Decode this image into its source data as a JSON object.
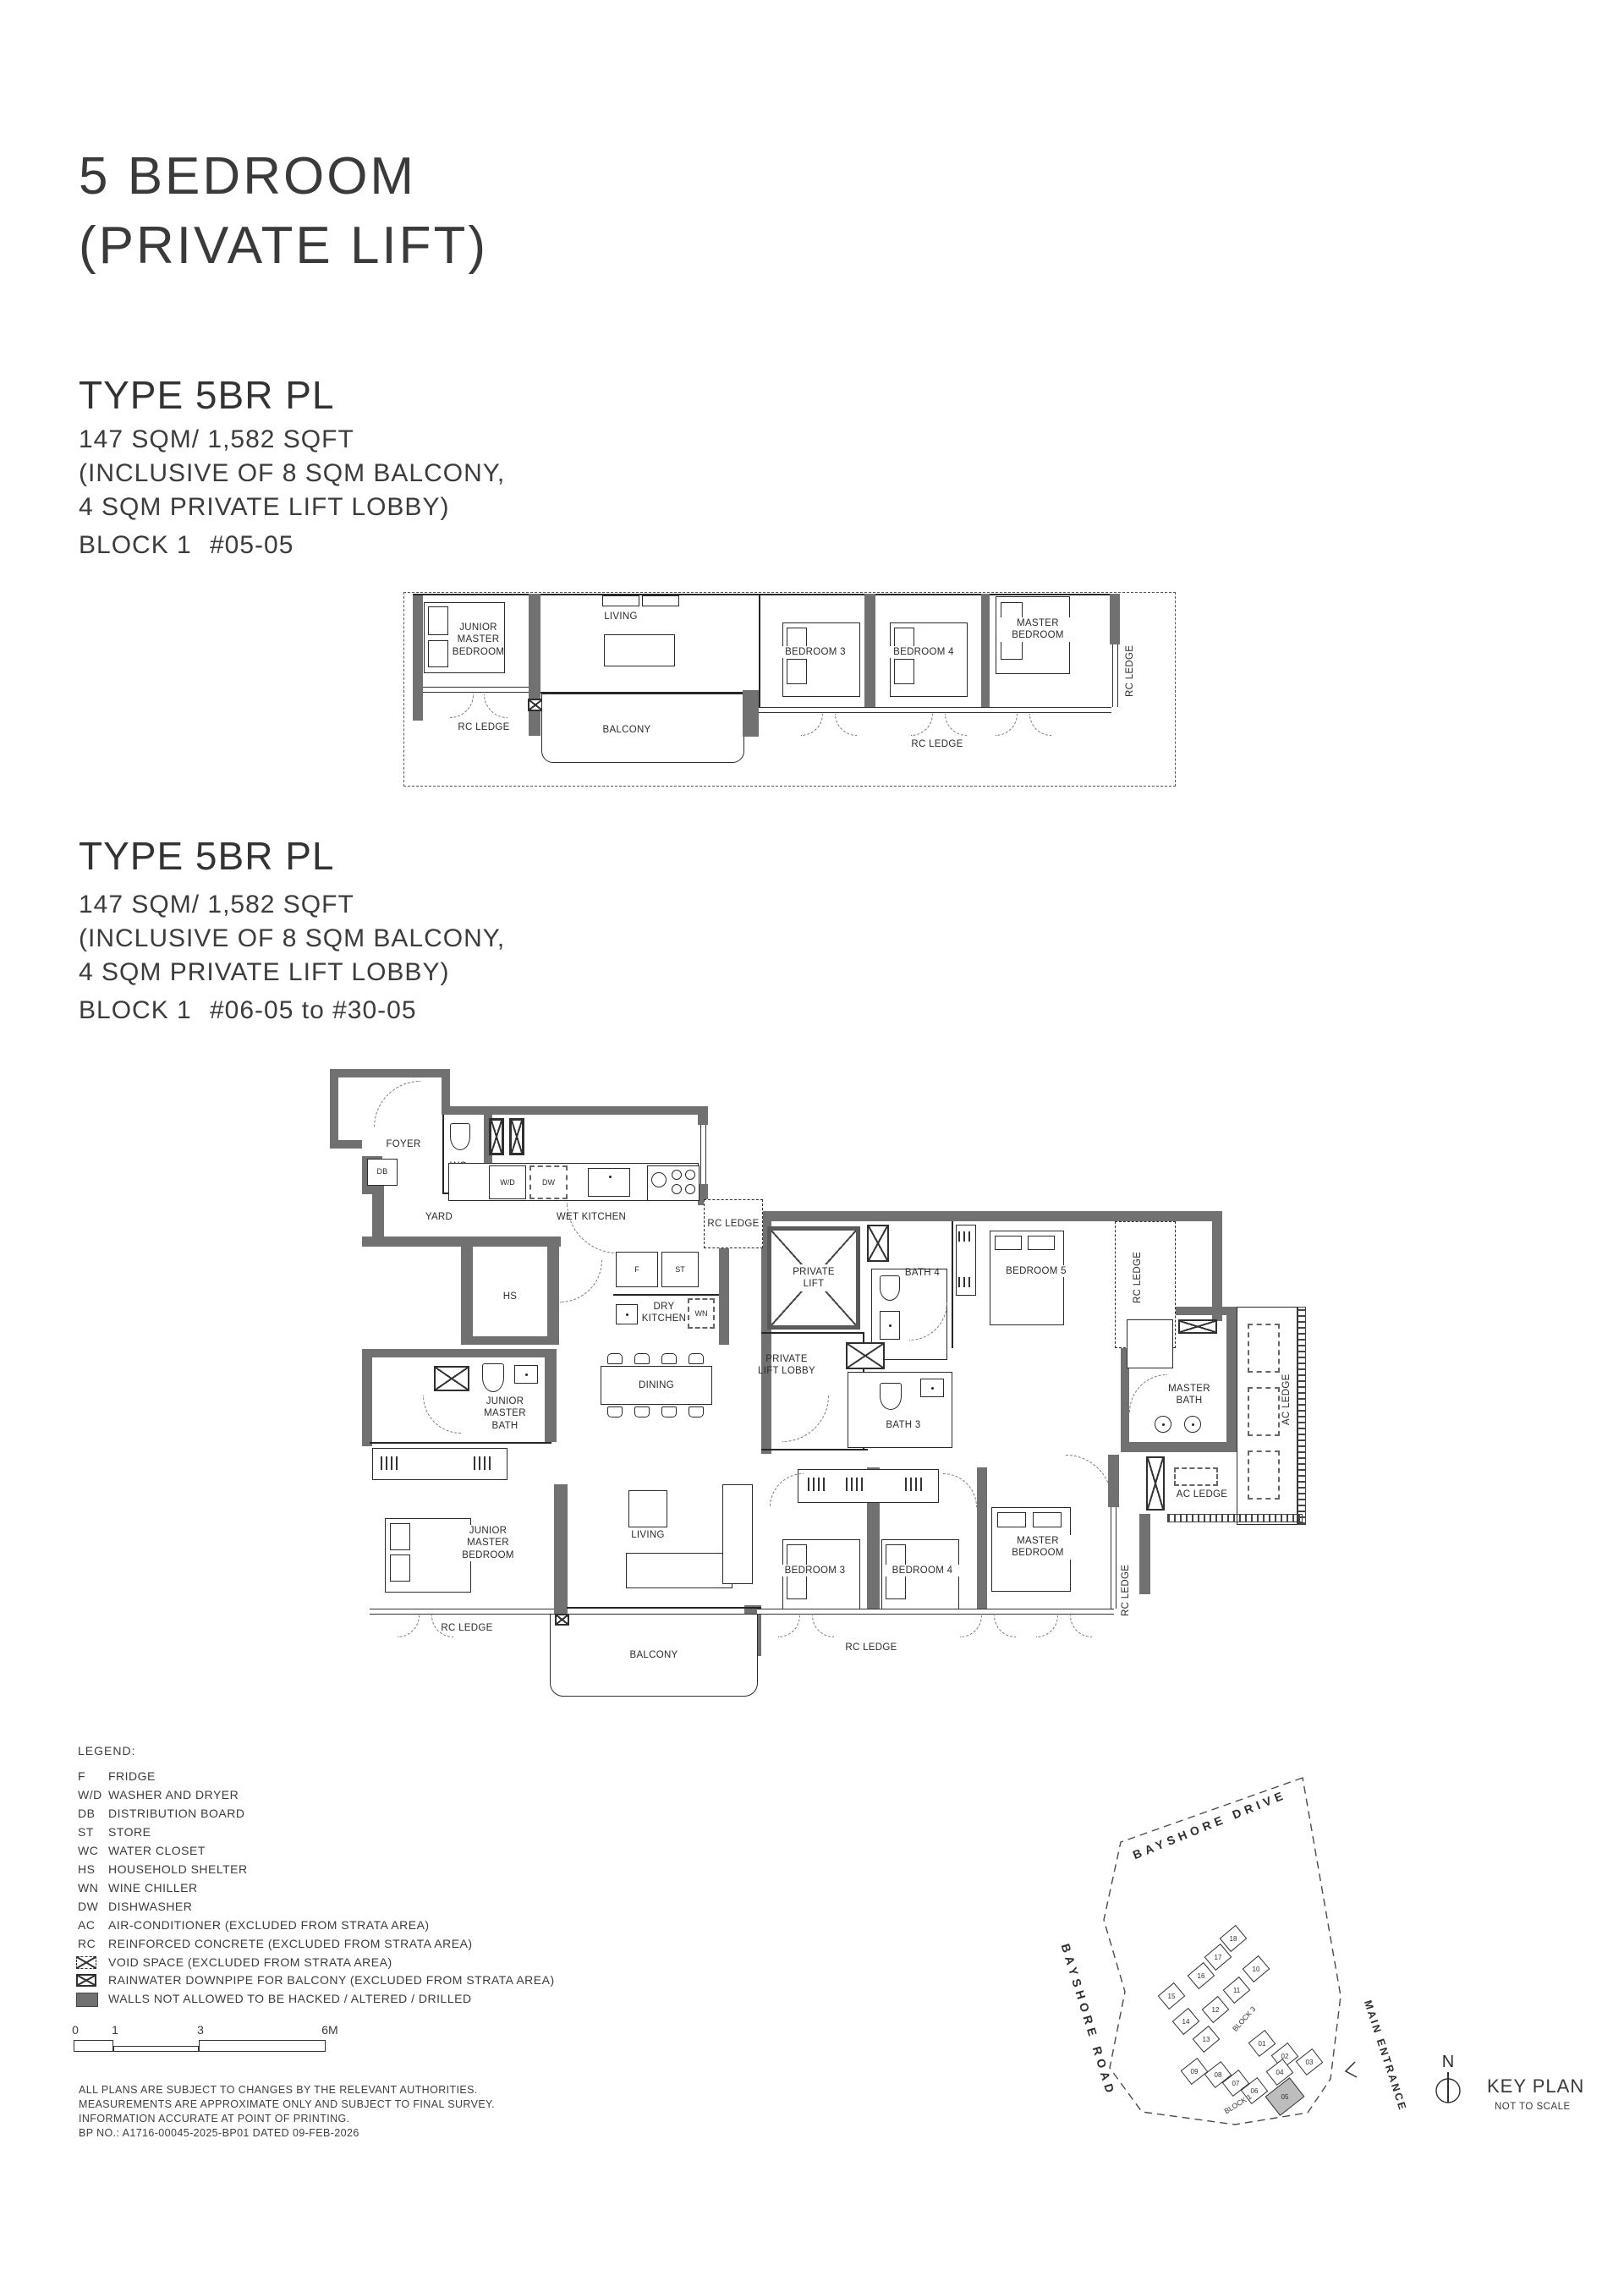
{
  "page": {
    "title_line1": "5 BEDROOM",
    "title_line2": "(PRIVATE LIFT)"
  },
  "types": {
    "t1": {
      "heading": "TYPE 5BR PL",
      "area": "147 SQM/ 1,582 SQFT",
      "incl1": "(INCLUSIVE OF 8 SQM BALCONY,",
      "incl2": "4 SQM PRIVATE LIFT LOBBY)",
      "block": "BLOCK 1",
      "unit": "#05-05"
    },
    "t2": {
      "heading": "TYPE 5BR PL",
      "area": "147 SQM/ 1,582 SQFT",
      "incl1": "(INCLUSIVE OF 8 SQM BALCONY,",
      "incl2": "4 SQM PRIVATE LIFT LOBBY)",
      "block": "BLOCK 1",
      "unit": "#06-05 to #30-05"
    }
  },
  "plan1": {
    "labels": {
      "junior_master_bedroom": "JUNIOR\nMASTER\nBEDROOM",
      "living": "LIVING",
      "bedroom3": "BEDROOM 3",
      "bedroom4": "BEDROOM 4",
      "master_bedroom": "MASTER\nBEDROOM",
      "rc_ledge_left": "RC LEDGE",
      "balcony": "BALCONY",
      "rc_ledge_bottom": "RC LEDGE",
      "rc_ledge_right": "RC LEDGE"
    }
  },
  "plan2": {
    "labels": {
      "foyer": "FOYER",
      "db": "DB",
      "wc": "WC",
      "yard": "YARD",
      "wet_kitchen": "WET KITCHEN",
      "wd": "W/D",
      "dw": "DW",
      "rc_ledge_top": "RC LEDGE",
      "hs": "HS",
      "f": "F",
      "st": "ST",
      "dry_kitchen": "DRY\nKITCHEN",
      "wn": "WN",
      "private_lift": "PRIVATE\nLIFT",
      "bath4": "BATH 4",
      "bedroom5": "BEDROOM 5",
      "rc_ledge_right": "RC LEDGE",
      "private_lift_lobby": "PRIVATE\nLIFT LOBBY",
      "bath3": "BATH 3",
      "master_bath": "MASTER\nBATH",
      "ac_ledge_right": "AC LEDGE",
      "ac_ledge_bottom": "AC LEDGE",
      "junior_master_bath": "JUNIOR\nMASTER\nBATH",
      "dining": "DINING",
      "junior_master_bedroom": "JUNIOR\nMASTER\nBEDROOM",
      "living": "LIVING",
      "bedroom3": "BEDROOM 3",
      "bedroom4": "BEDROOM 4",
      "master_bedroom": "MASTER\nBEDROOM",
      "rc_ledge_bottom_left": "RC LEDGE",
      "balcony": "BALCONY",
      "rc_ledge_bottom_mid": "RC LEDGE",
      "rc_ledge_bottom_right": "RC LEDGE"
    }
  },
  "legend": {
    "title": "LEGEND:",
    "items": [
      {
        "abbr": "F",
        "desc": "FRIDGE"
      },
      {
        "abbr": "W/D",
        "desc": "WASHER AND DRYER"
      },
      {
        "abbr": "DB",
        "desc": "DISTRIBUTION BOARD"
      },
      {
        "abbr": "ST",
        "desc": "STORE"
      },
      {
        "abbr": "WC",
        "desc": "WATER CLOSET"
      },
      {
        "abbr": "HS",
        "desc": "HOUSEHOLD SHELTER"
      },
      {
        "abbr": "WN",
        "desc": "WINE CHILLER"
      },
      {
        "abbr": "DW",
        "desc": "DISHWASHER"
      },
      {
        "abbr": "AC",
        "desc": "AIR-CONDITIONER (EXCLUDED FROM STRATA AREA)"
      },
      {
        "abbr": "RC",
        "desc": "REINFORCED CONCRETE (EXCLUDED FROM STRATA AREA)"
      }
    ],
    "icon_items": [
      {
        "icon": "void-space-icon",
        "desc": "VOID SPACE (EXCLUDED FROM STRATA AREA)"
      },
      {
        "icon": "rainwater-downpipe-icon",
        "desc": "RAINWATER DOWNPIPE FOR BALCONY (EXCLUDED FROM STRATA AREA)"
      },
      {
        "icon": "wall-swatch-icon",
        "desc": "WALLS NOT ALLOWED TO BE HACKED / ALTERED / DRILLED"
      }
    ]
  },
  "scalebar": {
    "t0": "0",
    "t1": "1",
    "t3": "3",
    "t6": "6M"
  },
  "disclaimer": {
    "lines": [
      "ALL PLANS ARE SUBJECT TO CHANGES BY THE RELEVANT AUTHORITIES.",
      "MEASUREMENTS ARE APPROXIMATE ONLY AND SUBJECT TO FINAL SURVEY.",
      "INFORMATION ACCURATE AT POINT OF PRINTING.",
      "BP NO.: A1716-00045-2025-BP01  DATED 09-FEB-2026"
    ]
  },
  "keyplan": {
    "roads": {
      "top": "BAYSHORE DRIVE",
      "left": "BAYSHORE ROAD",
      "right": "MAIN ENTRANCE"
    },
    "block3_label": "BLOCK 3",
    "block1_label": "BLOCK 1",
    "block3_units": [
      "18",
      "17",
      "16",
      "10",
      "11",
      "15",
      "12",
      "14",
      "13"
    ],
    "block1_units": [
      "01",
      "02",
      "03",
      "09",
      "08",
      "04",
      "07",
      "06",
      "05"
    ],
    "highlight_unit": "05",
    "highlight_color": "#bdbdbd",
    "north": "N",
    "title": "KEY PLAN",
    "subtitle": "NOT TO SCALE"
  }
}
